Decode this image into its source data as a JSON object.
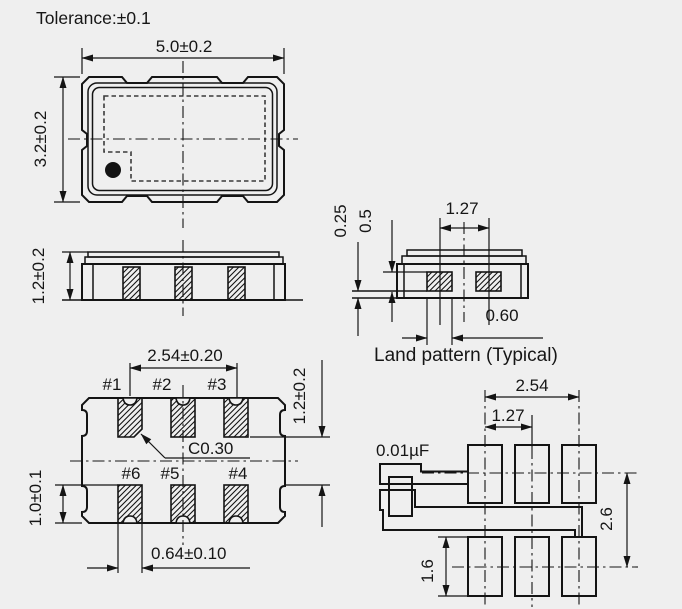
{
  "title": "Tolerance:±0.1",
  "top_view": {
    "width_dim": "5.0±0.2",
    "height_dim": "3.2±0.2"
  },
  "side_view": {
    "height_dim": "1.2±0.2"
  },
  "section_view": {
    "pad_pitch_dim": "1.27",
    "land_thickness_dim": "0.25",
    "electrode_height_dim": "0.5",
    "pad_width_dim": "0.60",
    "caption": "Land pattern (Typical)"
  },
  "bottom_view": {
    "pad_pitch_dim": "2.54±0.20",
    "row_gap_dim": "1.2±0.2",
    "pad_height_dim": "1.0±0.1",
    "pad_width_dim": "0.64±0.10",
    "chamfer_dim": "C0.30",
    "pad_labels": {
      "p1": "#1",
      "p2": "#2",
      "p3": "#3",
      "p6": "#6",
      "p5": "#5",
      "p4": "#4"
    }
  },
  "land_pattern": {
    "outer_pitch_dim": "2.54",
    "inner_pitch_dim": "1.27",
    "capacitor_label": "0.01µF",
    "row_pitch_dim": "2.6",
    "pad_height_dim": "1.6"
  },
  "colors": {
    "background": "#efefef",
    "line": "#141414",
    "text": "#161616"
  }
}
